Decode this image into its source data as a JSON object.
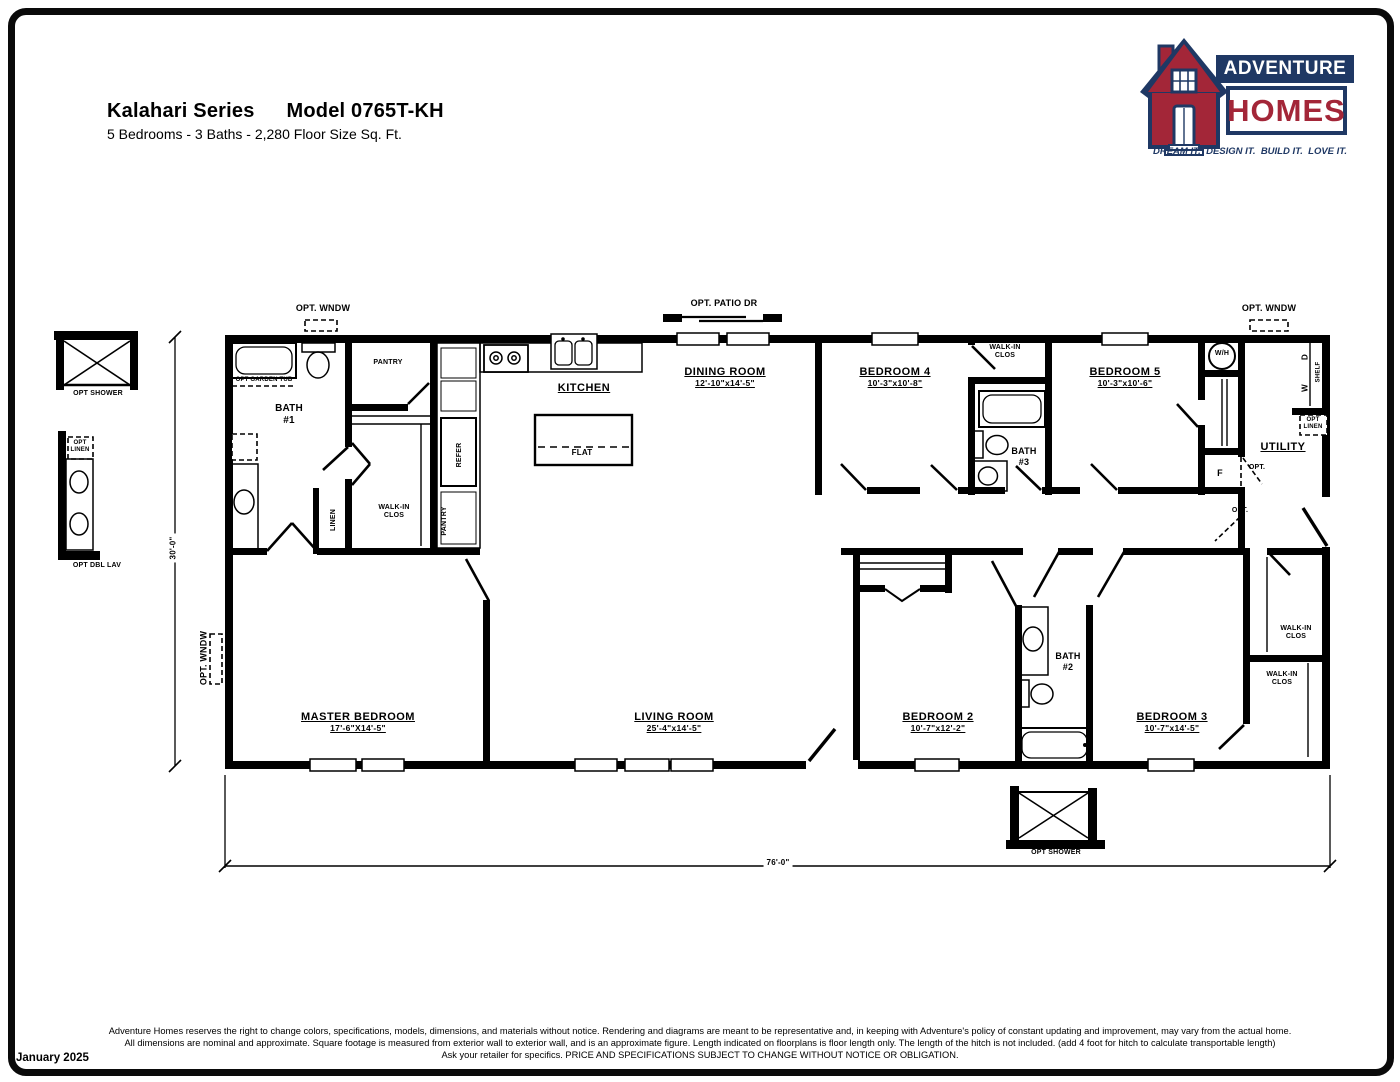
{
  "header": {
    "series": "Kalahari Series",
    "model": "Model 0765T-KH",
    "specs": "5 Bedrooms - 3 Baths - 2,280 Floor Size Sq. Ft."
  },
  "logo": {
    "brand_top": "ADVENTURE",
    "brand_bottom": "HOMES",
    "tagline": "DREAM IT.  DESIGN IT.  BUILD IT.  LOVE IT.",
    "colors": {
      "navy": "#1f3864",
      "red": "#a32638"
    }
  },
  "plan": {
    "rooms": {
      "kitchen": {
        "name": "KITCHEN"
      },
      "utility": {
        "name": "UTILITY"
      },
      "dining": {
        "name": "DINING ROOM",
        "dims": "12'-10\"x14'-5\""
      },
      "bedroom4": {
        "name": "BEDROOM 4",
        "dims": "10'-3\"x10'-8\""
      },
      "bedroom5": {
        "name": "BEDROOM 5",
        "dims": "10'-3\"x10'-6\""
      },
      "master": {
        "name": "MASTER BEDROOM",
        "dims": "17'-6\"X14'-5\""
      },
      "living": {
        "name": "LIVING ROOM",
        "dims": "25'-4\"x14'-5\""
      },
      "bedroom2": {
        "name": "BEDROOM 2",
        "dims": "10'-7\"x12'-2\""
      },
      "bedroom3": {
        "name": "BEDROOM 3",
        "dims": "10'-7\"x14'-5\""
      }
    },
    "labels": {
      "bath1": "BATH\n#1",
      "bath2": "BATH\n#2",
      "bath3": "BATH\n#3",
      "walk_in": "WALK-IN\nCLOS",
      "pantry": "PANTRY",
      "linen": "LINEN",
      "refer": "REFER",
      "flat": "FLAT",
      "wh": "W/H",
      "f": "F",
      "w": "W",
      "d": "D",
      "shelf": "SHELF",
      "opt": "OPT.",
      "opt_wndw": "OPT. WNDW",
      "opt_patio_dr": "OPT. PATIO DR",
      "opt_garden_tub": "OPT GARDEN TUB",
      "opt_linen": "OPT\nLINEN",
      "opt_shower": "OPT SHOWER",
      "opt_dbl_lav": "OPT DBL LAV"
    },
    "dimensions": {
      "width": "76'-0\"",
      "depth": "30'-0\""
    }
  },
  "footer": {
    "line1": "Adventure Homes reserves the right to change colors, specifications, models, dimensions, and materials without notice. Rendering and diagrams are meant to be representative and, in keeping with Adventure's policy of constant updating and improvement, may vary from the actual home.",
    "line2": "All dimensions are nominal and approximate. Square footage is measured from exterior wall to exterior wall, and is an approximate figure. Length indicated on floorplans is floor length only. The length of the hitch is not included. (add 4 foot for hitch to calculate transportable length)",
    "line3": "Ask your retailer for specifics. PRICE AND SPECIFICATIONS SUBJECT TO CHANGE WITHOUT NOTICE OR OBLIGATION.",
    "date": "January 2025"
  }
}
